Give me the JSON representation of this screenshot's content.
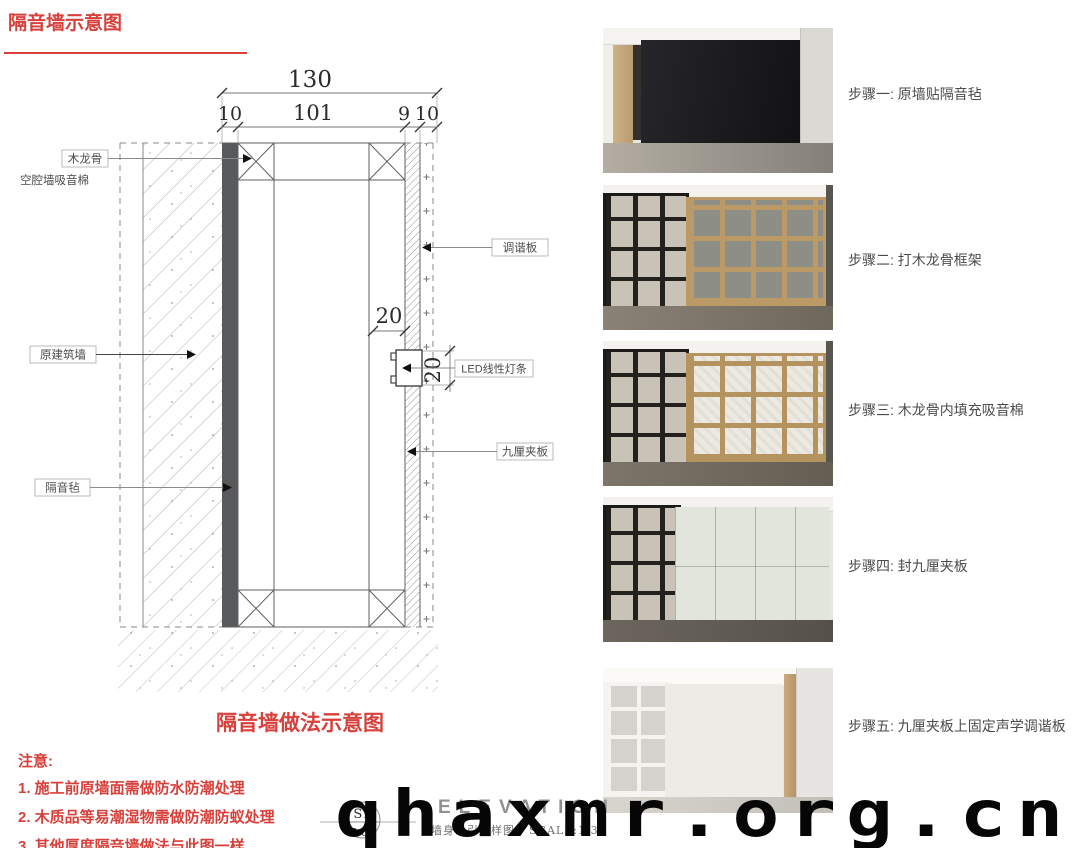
{
  "page": {
    "title": "隔音墙示意图",
    "watermark": "qhaxmr.org.cn"
  },
  "drawing": {
    "caption": "隔音墙做法示意图",
    "dims": {
      "total": "130",
      "seg1": "10",
      "seg2": "101",
      "seg3": "9",
      "seg4": "10",
      "led_w": "20",
      "led_h": "20"
    },
    "labels": {
      "wood_keel": "木龙骨",
      "cavity_cotton": "空腔墙吸音棉",
      "original_wall": "原建筑墙",
      "sound_felt": "隔音毡",
      "tuning_board": "调谐板",
      "led_strip": "LED线性灯条",
      "plywood": "九厘夹板"
    }
  },
  "notes": {
    "heading": "注意:",
    "items": [
      "1. 施工前原墙面需做防水防潮处理",
      "2. 木质品等易潮湿物需做防潮防蚁处理",
      "3. 其他厚度隔音墙做法与此图一样"
    ]
  },
  "stamp": {
    "code_top": "S1",
    "code_bottom": "E-03",
    "sheet_name": "墙身系引大样图",
    "scale": "SCALE:1/3",
    "bg_text": "ELEVATION"
  },
  "steps": [
    {
      "label": "步骤一: 原墙贴隔音毡"
    },
    {
      "label": "步骤二: 打木龙骨框架"
    },
    {
      "label": "步骤三: 木龙骨内填充吸音棉"
    },
    {
      "label": "步骤四: 封九厘夹板"
    },
    {
      "label": "步骤五: 九厘夹板上固定声学调谐板"
    }
  ],
  "colors": {
    "accent_red": "#d8403c",
    "felt": "#58595b",
    "line": "#666666"
  }
}
